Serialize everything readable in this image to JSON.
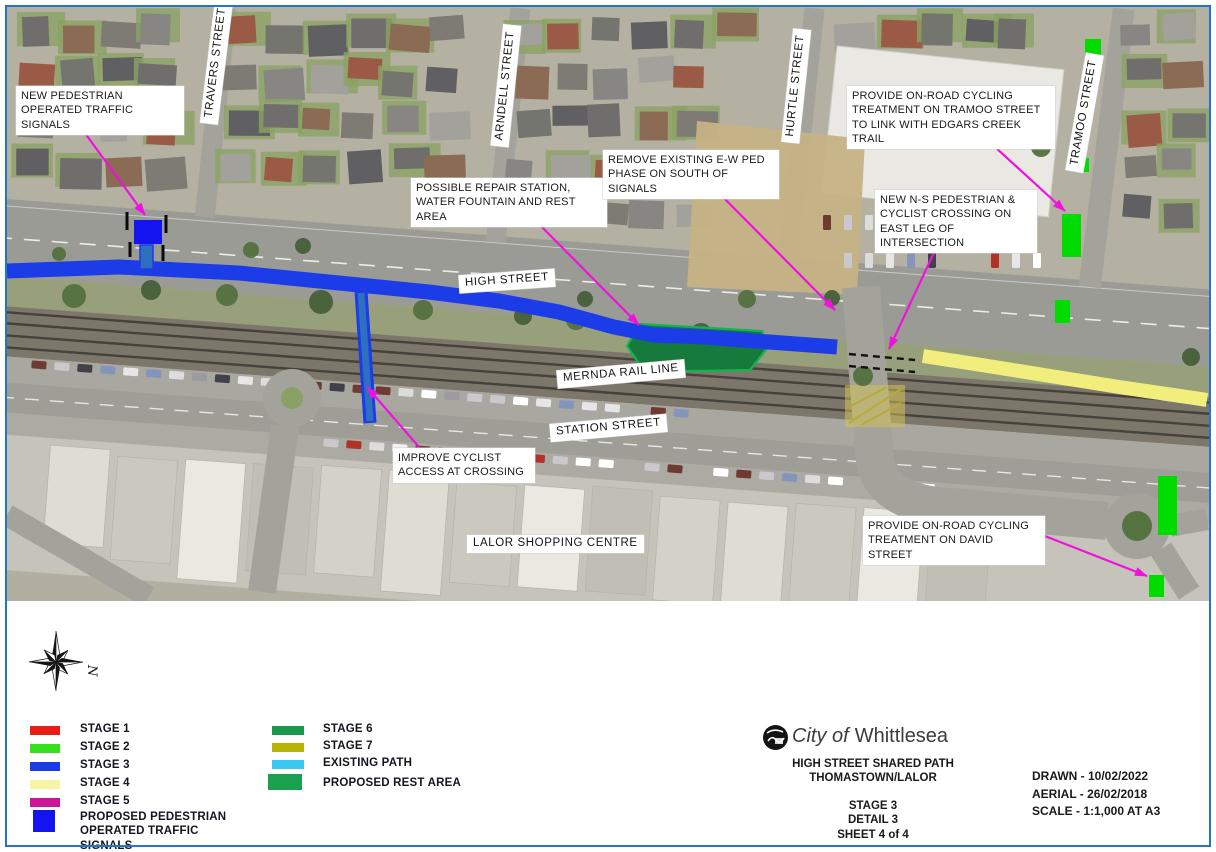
{
  "colors": {
    "frame": "#2176cc",
    "stage1": "#ea1c18",
    "stage2": "#35e01e",
    "stage3": "#1c3ce8",
    "stage4": "#f6f4a2",
    "stage5": "#cb1496",
    "stage6": "#17984c",
    "stage7": "#b7b407",
    "existing_path": "#38c8f0",
    "rest_area": "#1aa04e",
    "ped_signals": "#1414f0",
    "map_stage2_green": "#00dc00",
    "map_stage3_blue": "#1c3ce8",
    "map_stage4_yellow": "#f2ee7e",
    "map_rest_area_fill": "#157a3c",
    "map_rest_area_edge": "#12b44e",
    "arrow_magenta": "#f012dc"
  },
  "map": {
    "labels": {
      "high_street": "HIGH STREET",
      "mernda_rail_line": "MERNDA RAIL LINE",
      "station_street": "STATION STREET",
      "lalor_shopping_centre": "LALOR SHOPPING CENTRE",
      "travers_street": "TRAVERS STREET",
      "arndell_street": "ARNDELL STREET",
      "hurtle_street": "HURTLE STREET",
      "tramoo_street": "TRAMOO STREET"
    },
    "callouts": {
      "new_ped_signals": "NEW PEDESTRIAN OPERATED TRAFFIC SIGNALS",
      "possible_repair_station": "POSSIBLE REPAIR STATION, WATER FOUNTAIN AND REST AREA",
      "remove_ew_ped_phase": "REMOVE EXISTING E-W PED PHASE ON SOUTH OF SIGNALS",
      "tramoo_cycling": "PROVIDE ON-ROAD CYCLING TREATMENT ON TRAMOO STREET TO LINK WITH EDGARS CREEK TRAIL",
      "ns_crossing": "NEW N-S PEDESTRIAN & CYCLIST CROSSING ON EAST LEG OF INTERSECTION",
      "improve_cyclist_access": "IMPROVE CYCLIST ACCESS AT CROSSING",
      "david_st_cycling": "PROVIDE ON-ROAD CYCLING TREATMENT ON DAVID STREET"
    }
  },
  "legend": {
    "items": [
      {
        "label": "STAGE 1",
        "color": "#ea1c18"
      },
      {
        "label": "STAGE 2",
        "color": "#35e01e"
      },
      {
        "label": "STAGE 3",
        "color": "#1c3ce8"
      },
      {
        "label": "STAGE 4",
        "color": "#f6f4a2"
      },
      {
        "label": "STAGE 5",
        "color": "#cb1496"
      },
      {
        "label": "STAGE 6",
        "color": "#17984c"
      },
      {
        "label": "STAGE 7",
        "color": "#b7b407"
      },
      {
        "label": "EXISTING PATH",
        "color": "#38c8f0"
      },
      {
        "label": "PROPOSED REST AREA",
        "color": "#1aa04e"
      },
      {
        "label": "PROPOSED PEDESTRIAN OPERATED TRAFFIC SIGNALS",
        "color": "#1414f0"
      }
    ]
  },
  "title_block": {
    "org_prefix": "City of",
    "org_name": "Whittlesea",
    "project_line1": "HIGH STREET SHARED PATH",
    "project_line2": "THOMASTOWN/LALOR",
    "stage": "STAGE 3",
    "detail": "DETAIL 3",
    "sheet": "SHEET 4 of 4",
    "drawn": "DRAWN - 10/02/2022",
    "aerial": "AERIAL - 26/02/2018",
    "scale": "SCALE - 1:1,000 AT A3"
  },
  "north_arrow": {
    "label": "N"
  }
}
